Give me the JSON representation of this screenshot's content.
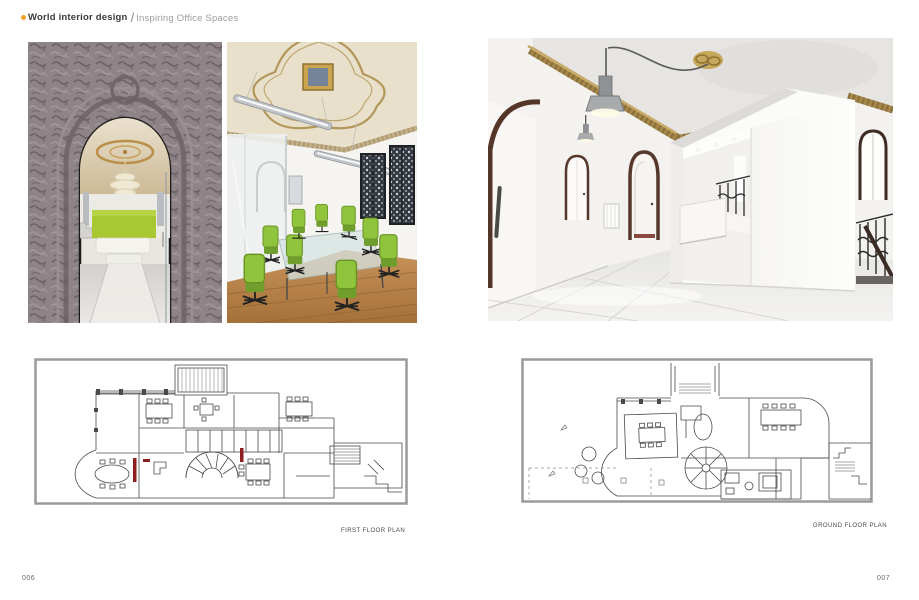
{
  "header": {
    "bullet_icon": "orange-dot",
    "title": "World interior design",
    "separator": "/",
    "subtitle": "Inspiring Office Spaces"
  },
  "photos": [
    {
      "id": "arch-entrance",
      "alt": "Ornate carved stone archway opening into a lounge with chandelier, lime-green wall and white seating"
    },
    {
      "id": "meeting-room",
      "alt": "Meeting room with ornate gilded ceiling, linear pendant lights, glass table and lime-green office chairs on wood floor"
    },
    {
      "id": "white-hall",
      "alt": "White hallway with gilded cornice, dark arched doorways, looping pendant lamp and freestanding white box volume beside an iron stair balustrade"
    }
  ],
  "floor_plans": [
    {
      "label": "FIRST FLOOR PLAN"
    },
    {
      "label": "GROUND FLOOR PLAN"
    }
  ],
  "footer": {
    "left_page_number": "006",
    "right_page_number": "007"
  },
  "colors": {
    "accent_bullet": "#f2a32b",
    "title_text": "#3a3a3a",
    "subtitle_text": "#9c9c9c",
    "lime_green": "#a3c635",
    "gold_trim": "#b3975a",
    "carved_stone": "#8e8386",
    "wood_floor": "#c28a4f",
    "plan_line": "#4a4a4a",
    "plan_red_mark": "#8e1f1f"
  }
}
